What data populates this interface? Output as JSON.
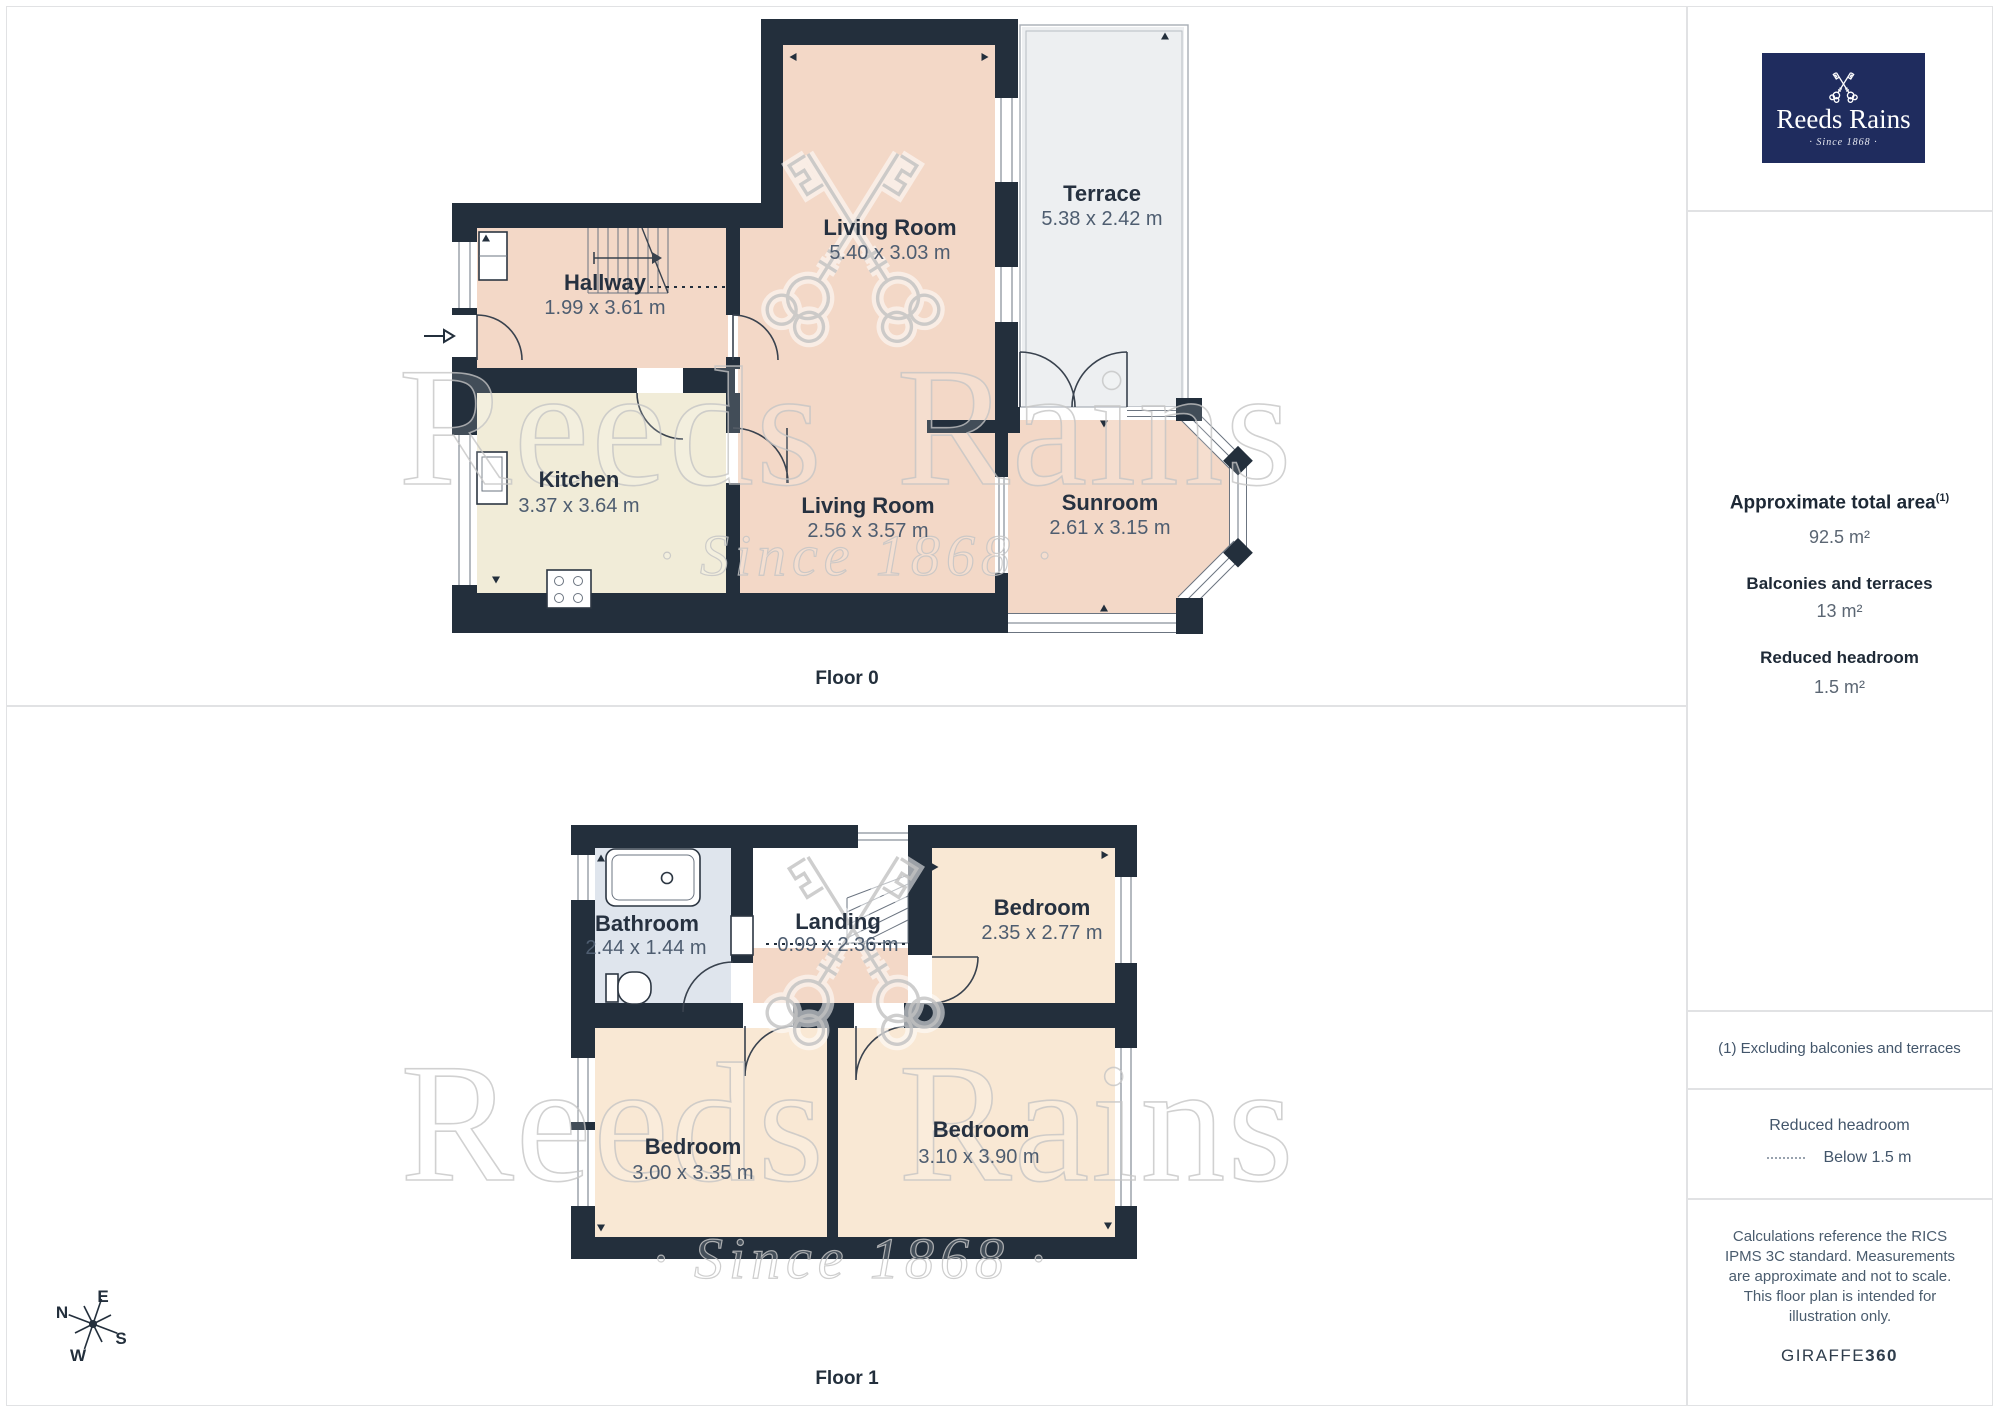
{
  "branding": {
    "logo_title": "Reeds Rains",
    "logo_tagline": "· Since 1868 ·",
    "watermark_title": "Reeds Rains",
    "watermark_tagline": "· Since 1868 ·",
    "giraffe_brand": "GIRAFFE",
    "giraffe_360": "360"
  },
  "sidebar": {
    "total_area_label": "Approximate total area",
    "total_area_sup": "(1)",
    "total_area_value": "92.5 m²",
    "balconies_label": "Balconies and terraces",
    "balconies_value": "13 m²",
    "reduced_label": "Reduced headroom",
    "reduced_value": "1.5 m²",
    "footnote": "(1) Excluding balconies and terraces",
    "legend_title": "Reduced headroom",
    "legend_item": "Below 1.5 m",
    "disclaimer": "Calculations reference the RICS IPMS 3C standard. Measurements are approximate and not to scale. This floor plan is intended for illustration only."
  },
  "floor0": {
    "caption": "Floor 0",
    "rooms": [
      {
        "name": "Hallway",
        "dims": "1.99 x 3.61 m"
      },
      {
        "name": "Kitchen",
        "dims": "3.37 x 3.64 m"
      },
      {
        "name": "Living Room",
        "dims": "5.40 x 3.03 m"
      },
      {
        "name": "Living Room",
        "dims": "2.56 x 3.57 m"
      },
      {
        "name": "Sunroom",
        "dims": "2.61 x 3.15 m"
      },
      {
        "name": "Terrace",
        "dims": "5.38 x 2.42 m"
      }
    ]
  },
  "floor1": {
    "caption": "Floor 1",
    "rooms": [
      {
        "name": "Bathroom",
        "dims": "2.44 x 1.44 m"
      },
      {
        "name": "Landing",
        "dims": "0.99 x 2.36 m"
      },
      {
        "name": "Bedroom",
        "dims": "2.35 x 2.77 m"
      },
      {
        "name": "Bedroom",
        "dims": "3.00 x 3.35 m"
      },
      {
        "name": "Bedroom",
        "dims": "3.10 x 3.90 m"
      }
    ]
  },
  "compass": {
    "n": "N",
    "e": "E",
    "s": "S",
    "w": "W"
  },
  "colors": {
    "brand_navy": "#1f2c5e",
    "wall": "#232f3c",
    "room_peach": "#f3d8c7",
    "room_cream": "#f1ecd8",
    "room_bedroom": "#f9e8d4",
    "room_bathroom": "#dfe5ed",
    "terrace_gray": "#edeff1",
    "label_dark": "#263140",
    "dims_gray": "#4e5d70"
  }
}
